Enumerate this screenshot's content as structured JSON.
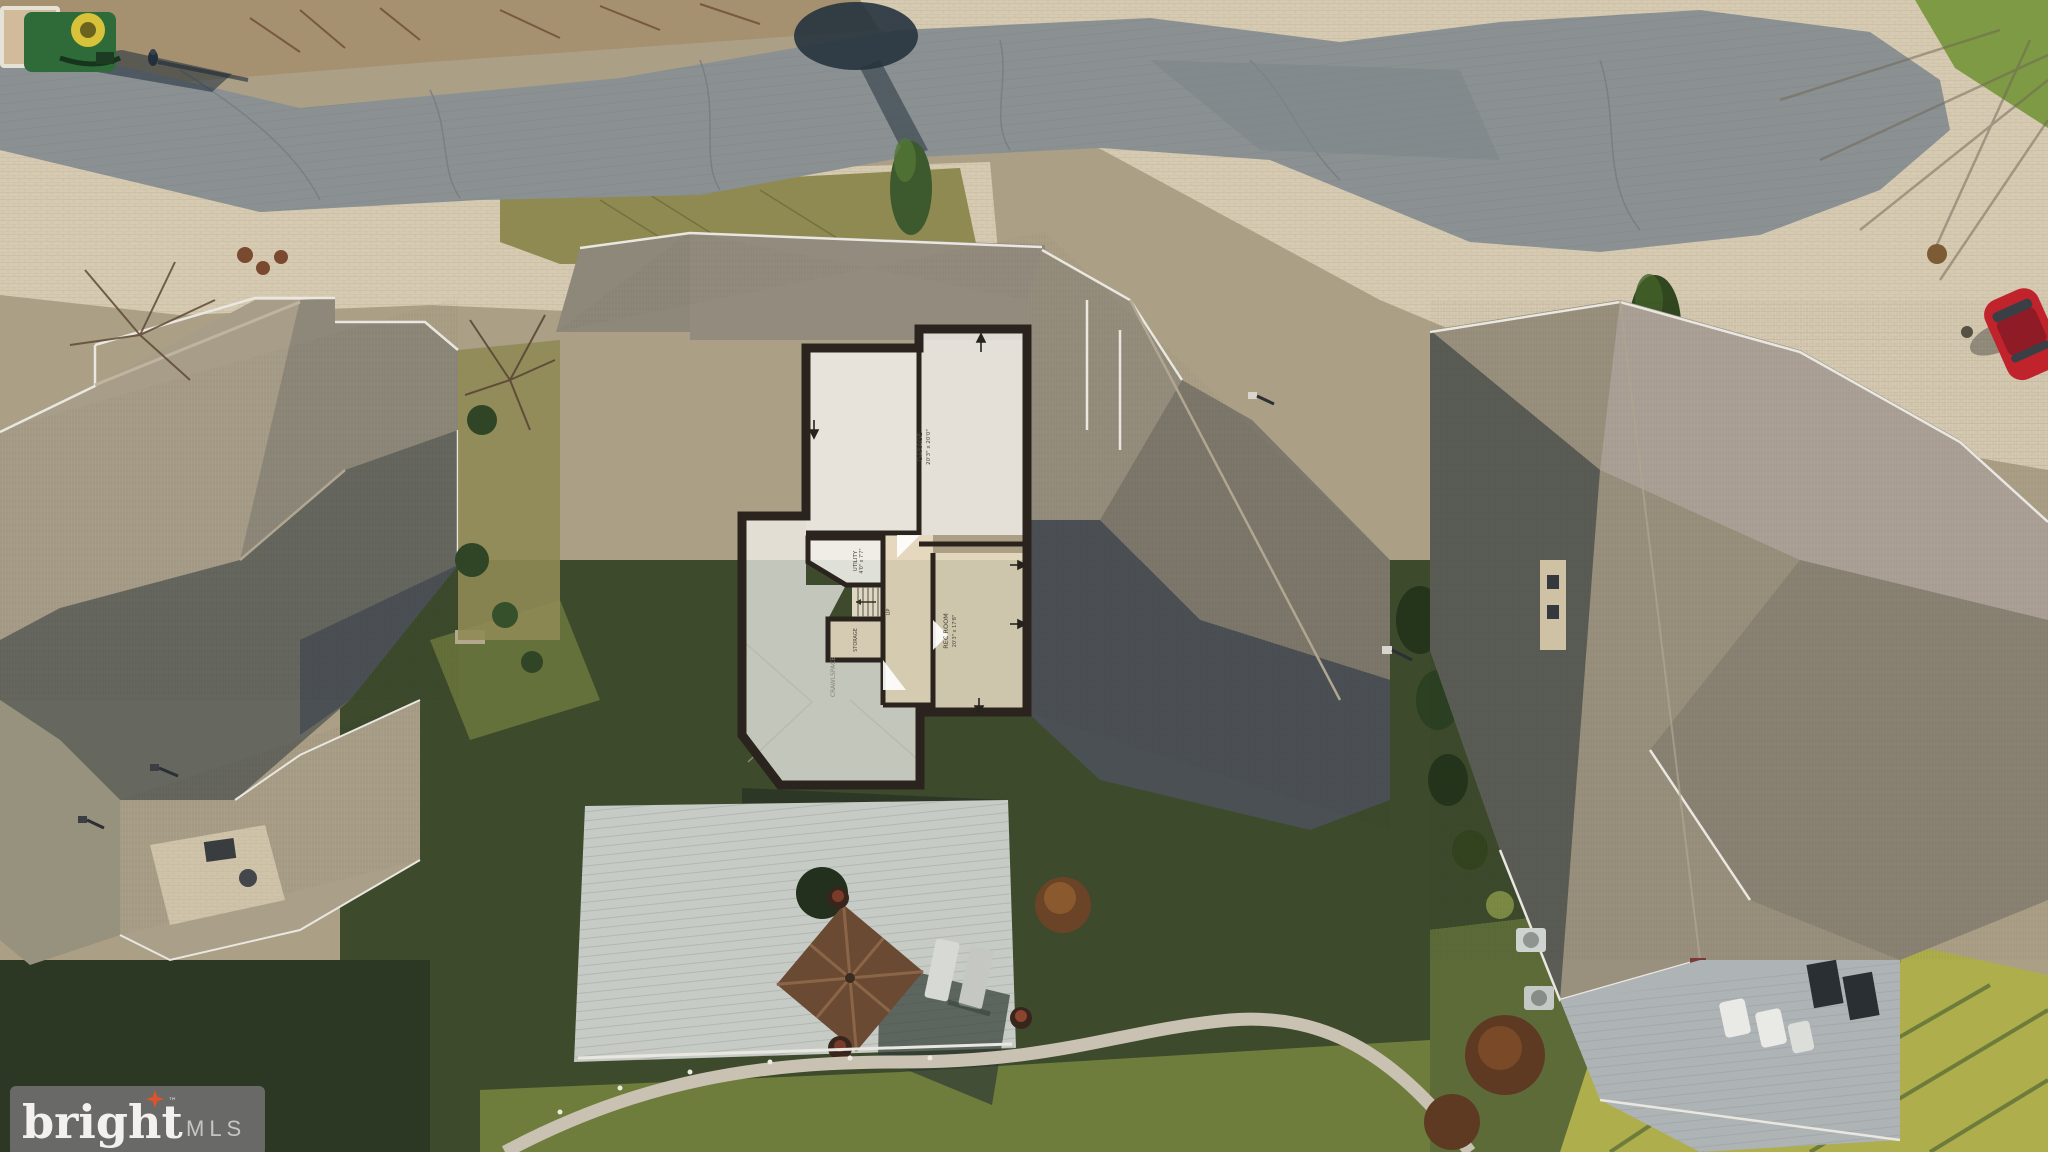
{
  "watermark": {
    "brand": "bright",
    "trademark_symbol": "™",
    "suffix": "MLS",
    "background_color": "#6e6e6e",
    "star_color": "#e0522a",
    "brand_color": "#f2f1ee",
    "suffix_color": "#c6c5c2"
  },
  "floorplan": {
    "garage_label": "GARAGE",
    "garage_dims": "20'3\" x 20'0\"",
    "utility_label": "UTILITY",
    "utility_dims": "4'0\" x 7'7\"",
    "storage_label": "STORAGE",
    "stairs_label": "STAIRS",
    "up_label": "UP",
    "recroom_label": "REC ROOM",
    "recroom_dims": "20'3\" x 17'8\"",
    "crawlspace_label": "CRAWLSPACE"
  },
  "palette": {
    "asphalt": "#8b9193",
    "pavers": "#d6cbb2",
    "dirt": "#a5906f",
    "roof_sun": "#a79d89",
    "roof_mid": "#8e887a",
    "roof_dark": "#66675f",
    "roof_shadow": "#4b5054",
    "grass_dark": "#3d4a2c",
    "grass_olive": "#8f8a51",
    "grass_bright": "#aeae4c",
    "grass_patch": "#7e9a45",
    "plan_wall": "#2b241e",
    "plan_white": "#f7f6f2",
    "plan_beige": "#eee2c8",
    "deck": "#c7cbc6",
    "umbrella": "#6b4a33",
    "truck_green": "#2e6b38",
    "car_red": "#c0232c"
  }
}
